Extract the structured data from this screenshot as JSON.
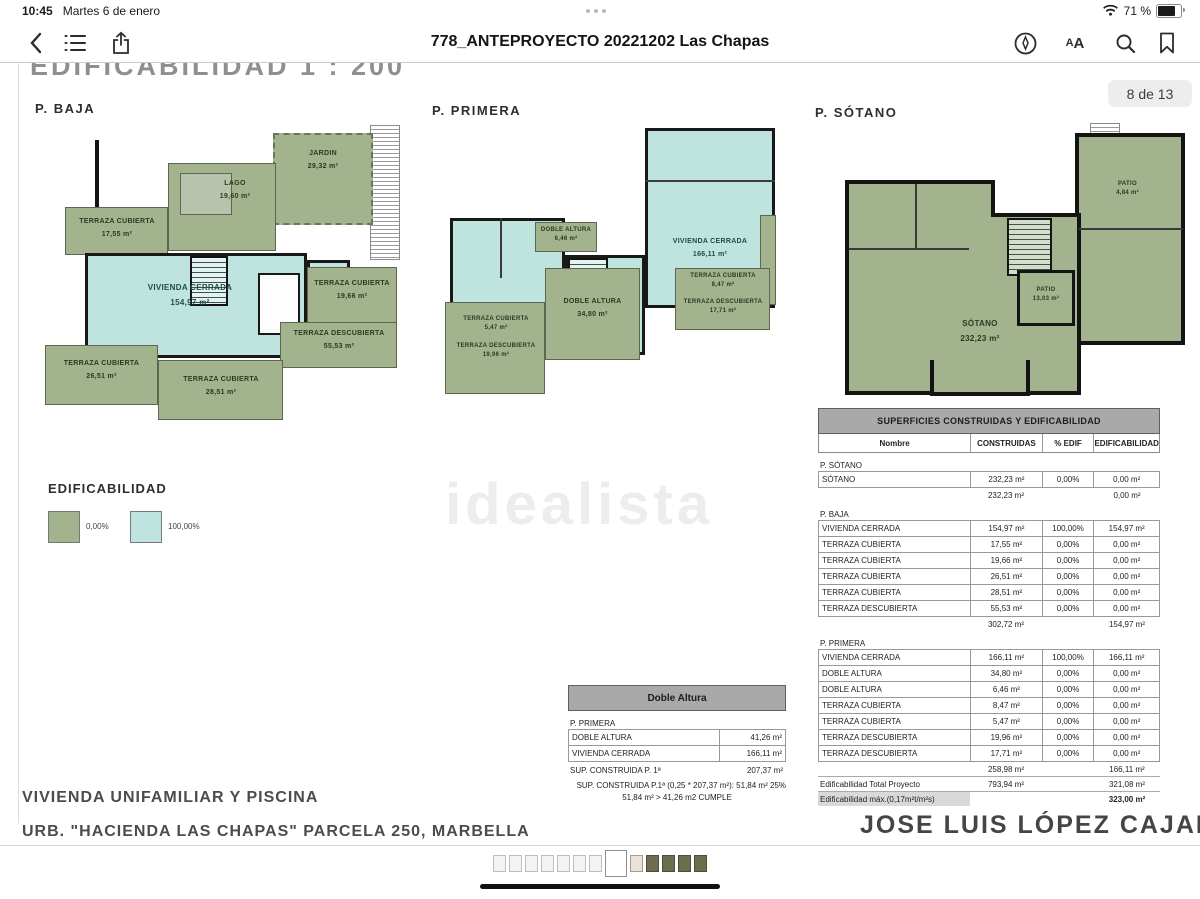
{
  "status_bar": {
    "time": "10:45",
    "date": "Martes 6 de enero",
    "battery": "71 %"
  },
  "toolbar": {
    "title": "778_ANTEPROYECTO 20221202 Las Chapas"
  },
  "page": {
    "heading": "EDIFICABILIDAD  1 : 200",
    "page_badge": "8 de 13",
    "watermark": "idealista",
    "plans": [
      {
        "name": "P. BAJA",
        "rooms": [
          {
            "label": "JARDIN",
            "area": "29,32 m²"
          },
          {
            "label": "LAGO",
            "area": "19,60 m²"
          },
          {
            "label": "TERRAZA CUBIERTA",
            "area": "17,55 m²"
          },
          {
            "label": "VIVIENDA CERRADA",
            "area": "154,97 m²"
          },
          {
            "label": "TERRAZA CUBIERTA",
            "area": "19,66 m²"
          },
          {
            "label": "TERRAZA DESCUBIERTA",
            "area": "55,53 m²"
          },
          {
            "label": "TERRAZA CUBIERTA",
            "area": "26,51 m²"
          },
          {
            "label": "TERRAZA CUBIERTA",
            "area": "28,51 m²"
          }
        ]
      },
      {
        "name": "P. PRIMERA",
        "rooms": [
          {
            "label": "DOBLE ALTURA",
            "area": "6,46 m²"
          },
          {
            "label": "VIVIENDA CERRADA",
            "area": "166,11 m²"
          },
          {
            "label": "DOBLE ALTURA",
            "area": "34,80 m²"
          },
          {
            "label": "TERRAZA CUBIERTA",
            "area": "8,47 m²"
          },
          {
            "label": "TERRAZA DESCUBIERTA",
            "area": "17,71 m²"
          },
          {
            "label": "TERRAZA CUBIERTA",
            "area": "5,47 m²"
          },
          {
            "label": "TERRAZA DESCUBIERTA",
            "area": "19,96 m²"
          }
        ]
      },
      {
        "name": "P. SÓTANO",
        "rooms": [
          {
            "label": "SÓTANO",
            "area": "232,23 m²"
          },
          {
            "label": "PATIO",
            "area": "13,03 m²"
          },
          {
            "label": "PATIO",
            "area": "4,84 m²"
          }
        ]
      }
    ],
    "legend": {
      "title": "EDIFICABILIDAD",
      "items": [
        {
          "label": "0,00%",
          "color": "#a2b38e"
        },
        {
          "label": "100,00%",
          "color": "#bfe4e0"
        }
      ]
    },
    "doble_altura_table": {
      "title": "Doble Altura",
      "section": "P. PRIMERA",
      "rows": [
        [
          "DOBLE ALTURA",
          "41,26 m²"
        ],
        [
          "VIVIENDA CERRADA",
          "166,11 m²"
        ]
      ],
      "sum_label": "SUP. CONSTRUIDA P. 1ª",
      "sum_value": "207,37 m²",
      "check_line1": "25% SUP. CONSTRUIDA P.1ª (0,25 * 207,37 m²):  51,84 m²",
      "check_line2": "51,84 m²  >  41,26 m2  CUMPLE"
    },
    "main_table": {
      "title": "SUPERFICIES CONSTRUIDAS Y EDIFICABILIDAD",
      "columns": [
        "Nombre",
        "CONSTRUIDAS",
        "% EDIF",
        "EDIFICABILIDAD"
      ],
      "sections": [
        {
          "name": "P. SÓTANO",
          "rows": [
            [
              "SÓTANO",
              "232,23 m²",
              "0,00%",
              "0,00 m²"
            ]
          ],
          "subtotal": [
            "232,23 m²",
            "",
            "0,00 m²"
          ]
        },
        {
          "name": "P. BAJA",
          "rows": [
            [
              "VIVIENDA CERRADA",
              "154,97 m²",
              "100,00%",
              "154,97 m²"
            ],
            [
              "TERRAZA CUBIERTA",
              "17,55 m²",
              "0,00%",
              "0,00 m²"
            ],
            [
              "TERRAZA CUBIERTA",
              "19,66 m²",
              "0,00%",
              "0,00 m²"
            ],
            [
              "TERRAZA CUBIERTA",
              "26,51 m²",
              "0,00%",
              "0,00 m²"
            ],
            [
              "TERRAZA CUBIERTA",
              "28,51 m²",
              "0,00%",
              "0,00 m²"
            ],
            [
              "TERRAZA DESCUBIERTA",
              "55,53 m²",
              "0,00%",
              "0,00 m²"
            ]
          ],
          "subtotal": [
            "302,72 m²",
            "",
            "154,97 m²"
          ]
        },
        {
          "name": "P. PRIMERA",
          "rows": [
            [
              "VIVIENDA CERRADA",
              "166,11 m²",
              "100,00%",
              "166,11 m²"
            ],
            [
              "DOBLE ALTURA",
              "34,80 m²",
              "0,00%",
              "0,00 m²"
            ],
            [
              "DOBLE ALTURA",
              "6,46 m²",
              "0,00%",
              "0,00 m²"
            ],
            [
              "TERRAZA CUBIERTA",
              "8,47 m²",
              "0,00%",
              "0,00 m²"
            ],
            [
              "TERRAZA CUBIERTA",
              "5,47 m²",
              "0,00%",
              "0,00 m²"
            ],
            [
              "TERRAZA DESCUBIERTA",
              "19,96 m²",
              "0,00%",
              "0,00 m²"
            ],
            [
              "TERRAZA DESCUBIERTA",
              "17,71 m²",
              "0,00%",
              "0,00 m²"
            ]
          ],
          "subtotal": [
            "258,98 m²",
            "",
            "166,11 m²"
          ]
        }
      ],
      "totals": [
        {
          "label": "Edificabilidad Total Proyecto",
          "construidas": "793,94 m²",
          "edificabilidad": "321,08 m²"
        },
        {
          "label": "Edificabilidad máx.(0,17m²t/m²s)",
          "construidas": "",
          "edificabilidad": "323,00 m²"
        }
      ]
    },
    "footer": {
      "project_title": "VIVIENDA UNIFAMILIAR Y PISCINA",
      "project_subtitle": "URB. \"HACIENDA LAS CHAPAS\" PARCELA 250, MARBELLA",
      "architect": "JOSE LUIS LÓPEZ CAJAL"
    }
  },
  "thumbnail_strip": {
    "total": 13,
    "active": 8
  }
}
